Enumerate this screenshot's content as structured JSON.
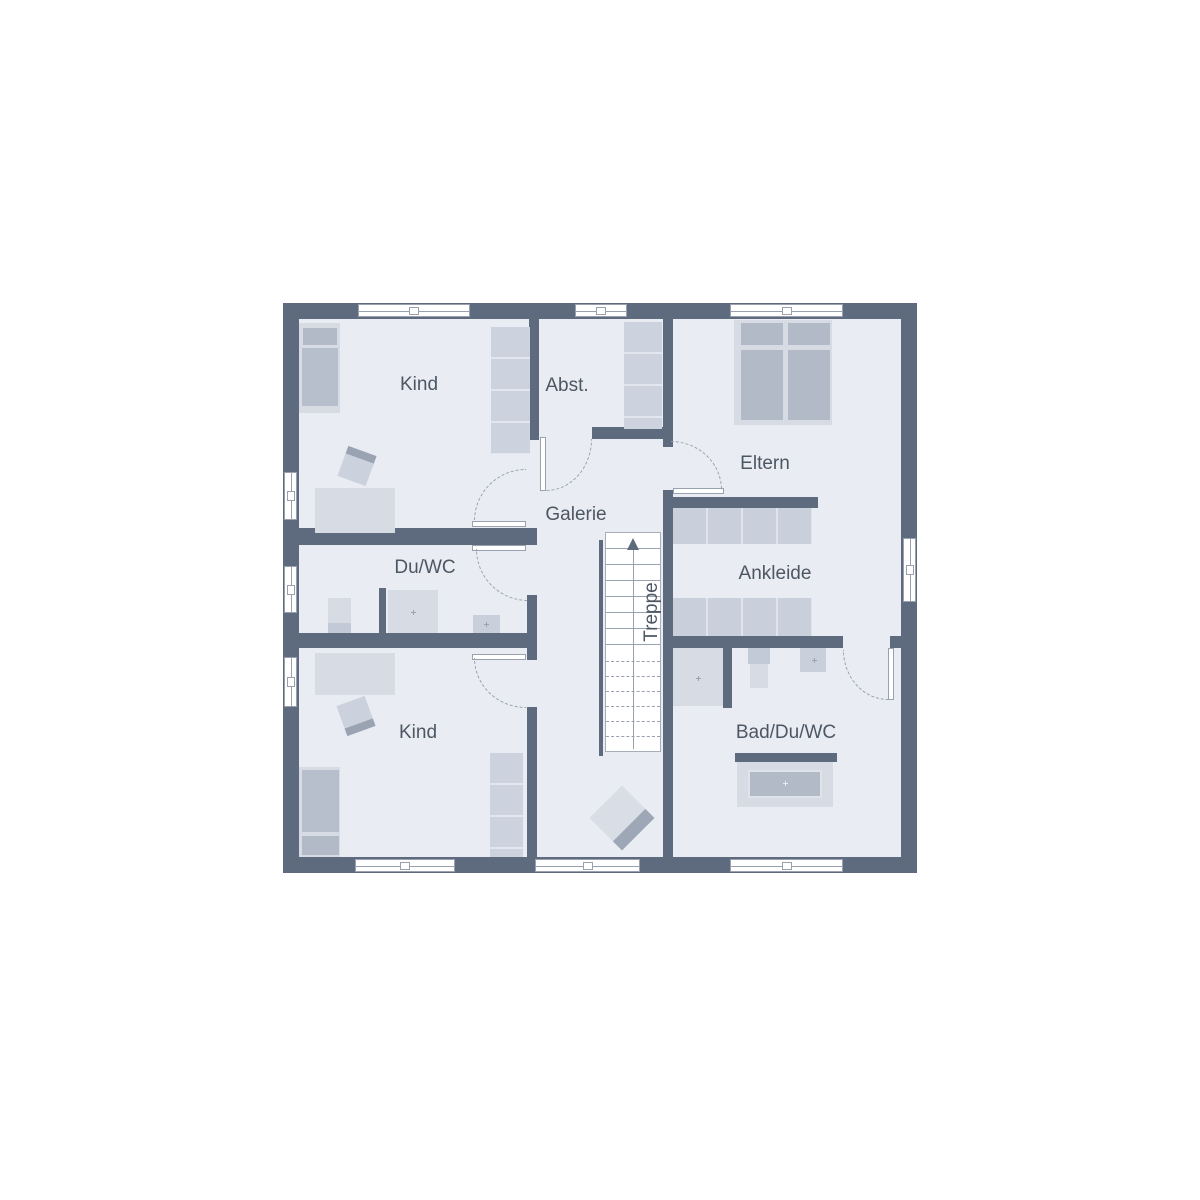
{
  "rooms": {
    "kind_top": "Kind",
    "abstellraum": "Abst.",
    "eltern": "Eltern",
    "galerie": "Galerie",
    "du_wc": "Du/WC",
    "ankleide": "Ankleide",
    "treppe": "Treppe",
    "bad_du_wc": "Bad/Du/WC",
    "kind_bottom": "Kind"
  },
  "icons": {
    "stairs_direction": "arrow-up"
  },
  "colors": {
    "wall": "#5e6b7e",
    "floor": "#e9ecf2",
    "line": "#98a1ad",
    "text": "#4d5763",
    "furniture_light": "#d6dbe4",
    "furniture_mid": "#c9cfdb",
    "furniture_dark": "#b2b9c7"
  }
}
